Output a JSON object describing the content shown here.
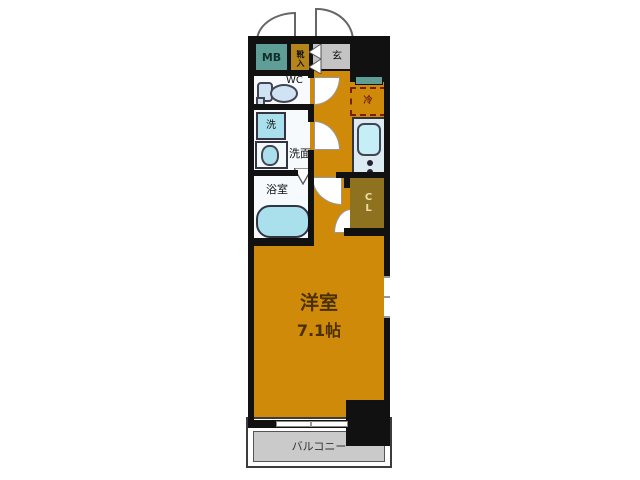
{
  "colors": {
    "orange": "#d08a09",
    "teal": "#5f9e96",
    "mustard": "#b5851c",
    "entrance-gray": "#c4c4c4",
    "olive": "#8e7220",
    "cyan": "#a9e0ec",
    "kitchen-bg": "#dceaf2",
    "wall": "#111111",
    "balcony-gray": "#cacaca",
    "fridge-accent": "#7a2000",
    "room-text": "#4a3000",
    "closet-text": "#e9dfa6"
  },
  "plan": {
    "rooms": {
      "meter_box": "MB",
      "shoe_box": "靴入",
      "entrance": "玄",
      "toilet": "WC",
      "washer": "洗",
      "vanity": "洗面",
      "bathroom": "浴室",
      "refrigerator": "冷",
      "closet": "CL",
      "main_room_name": "洋室",
      "main_room_size": "7.1帖",
      "balcony": "バルコニー"
    }
  }
}
